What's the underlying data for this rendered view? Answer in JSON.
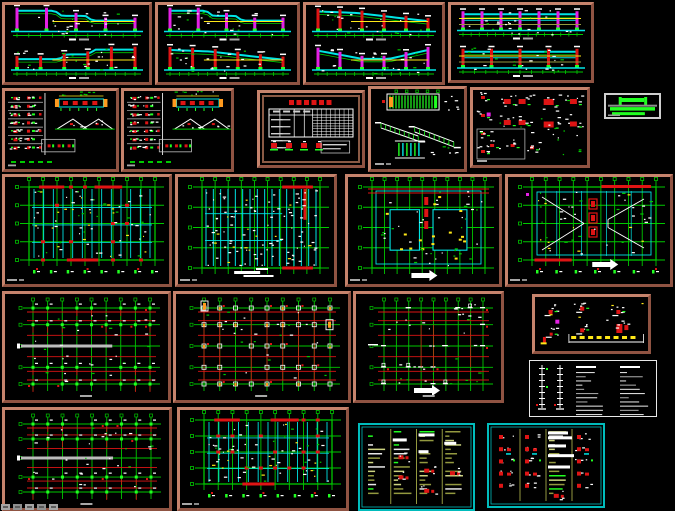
{
  "canvas": {
    "w": 675,
    "h": 511,
    "bg": "#000000"
  },
  "palette": {
    "salmon": "#b3705c",
    "salmonDark": "#8f5342",
    "green": "#00c800",
    "brightGreen": "#21ff21",
    "cyan": "#00e5e5",
    "cyanBorder": "#00bcbc",
    "red": "#de1414",
    "magenta": "#e520e5",
    "yellow": "#ffe818",
    "orange": "#ff9a1e",
    "white": "#ffffff",
    "gray": "#a8a8a8",
    "olive": "#93993f",
    "oliveLight": "#ccd37f",
    "tableBrown": "#8a5a45"
  },
  "watermark": {
    "blocks": 5
  },
  "panels": [
    {
      "name": "sheet-elevation-1",
      "type": "elevation",
      "x": 2,
      "y": 2,
      "w": 150,
      "h": 83,
      "border": "salmon",
      "seed": 11,
      "sections": [
        {
          "colColor": "magenta",
          "cols": 5,
          "profile": "step-down"
        },
        {
          "colColor": "red",
          "cols": 6,
          "profile": "step-up"
        }
      ]
    },
    {
      "name": "sheet-elevation-2",
      "type": "elevation",
      "x": 155,
      "y": 2,
      "w": 145,
      "h": 83,
      "border": "salmon",
      "seed": 12,
      "sections": [
        {
          "colColor": "magenta",
          "cols": 5,
          "profile": "step-down"
        },
        {
          "colColor": "red",
          "cols": 6,
          "profile": "slope-up"
        }
      ]
    },
    {
      "name": "sheet-elevation-3",
      "type": "elevation",
      "x": 303,
      "y": 2,
      "w": 142,
      "h": 83,
      "border": "salmon",
      "seed": 13,
      "sections": [
        {
          "colColor": "red",
          "cols": 6,
          "profile": "slope-up"
        },
        {
          "colColor": "magenta",
          "cols": 6,
          "profile": "valley"
        }
      ]
    },
    {
      "name": "sheet-elevation-4",
      "type": "elevation",
      "x": 448,
      "y": 2,
      "w": 146,
      "h": 81,
      "border": "salmon",
      "seed": 14,
      "sections": [
        {
          "colColor": "magenta",
          "cols": 7,
          "profile": "flat",
          "yellowFull": true
        },
        {
          "colColor": "red",
          "cols": 5,
          "profile": "flat",
          "yellowFull": true
        }
      ]
    },
    {
      "name": "sheet-details-1",
      "type": "details",
      "x": 2,
      "y": 88,
      "w": 117,
      "h": 84,
      "border": "salmon",
      "seed": 21
    },
    {
      "name": "sheet-details-2",
      "type": "details",
      "x": 121,
      "y": 88,
      "w": 113,
      "h": 84,
      "border": "salmon",
      "seed": 22
    },
    {
      "name": "sheet-schedule-table",
      "type": "table",
      "x": 257,
      "y": 90,
      "w": 108,
      "h": 78,
      "border": "salmon",
      "seed": 23
    },
    {
      "name": "sheet-stairs",
      "type": "stairs",
      "x": 368,
      "y": 86,
      "w": 99,
      "h": 86,
      "border": "salmon",
      "seed": 24
    },
    {
      "name": "sheet-details-3",
      "type": "details2",
      "x": 470,
      "y": 87,
      "w": 120,
      "h": 81,
      "border": "salmon",
      "seed": 25
    },
    {
      "name": "legend-block",
      "type": "logo",
      "x": 604,
      "y": 93,
      "w": 57,
      "h": 26,
      "border": "gray",
      "seed": 26
    },
    {
      "name": "sheet-plan-1",
      "type": "plan",
      "variant": "beams-red",
      "x": 2,
      "y": 174,
      "w": 170,
      "h": 113,
      "border": "salmon",
      "seed": 31
    },
    {
      "name": "sheet-plan-2",
      "type": "plan",
      "variant": "beams-dense",
      "x": 175,
      "y": 174,
      "w": 162,
      "h": 113,
      "border": "salmon",
      "seed": 32
    },
    {
      "name": "sheet-plan-3",
      "type": "plan",
      "variant": "voids",
      "x": 345,
      "y": 174,
      "w": 157,
      "h": 113,
      "border": "salmon",
      "seed": 33
    },
    {
      "name": "sheet-plan-4",
      "type": "plan",
      "variant": "roof",
      "x": 505,
      "y": 174,
      "w": 168,
      "h": 113,
      "border": "salmon",
      "seed": 34
    },
    {
      "name": "sheet-column-plan-1",
      "type": "colplan",
      "variant": "graybar",
      "x": 2,
      "y": 291,
      "w": 169,
      "h": 112,
      "border": "salmon",
      "seed": 41
    },
    {
      "name": "sheet-column-plan-2",
      "type": "colplan",
      "variant": "orange",
      "x": 173,
      "y": 291,
      "w": 178,
      "h": 112,
      "border": "salmon",
      "seed": 42
    },
    {
      "name": "sheet-column-plan-3",
      "type": "colplan",
      "variant": "sparse",
      "x": 353,
      "y": 291,
      "w": 151,
      "h": 112,
      "border": "salmon",
      "seed": 43
    },
    {
      "name": "sheet-foundation-details",
      "type": "minidetails",
      "x": 532,
      "y": 294,
      "w": 119,
      "h": 60,
      "border": "salmon",
      "seed": 44
    },
    {
      "name": "sheet-notes-general",
      "type": "notes",
      "x": 529,
      "y": 360,
      "w": 128,
      "h": 57,
      "border": "white",
      "seed": 45
    },
    {
      "name": "sheet-column-plan-4",
      "type": "colplan",
      "variant": "graybar",
      "x": 2,
      "y": 407,
      "w": 170,
      "h": 104,
      "border": "salmon",
      "seed": 51
    },
    {
      "name": "sheet-plan-5",
      "type": "plan",
      "variant": "beams-red",
      "x": 177,
      "y": 407,
      "w": 172,
      "h": 104,
      "border": "salmon",
      "seed": 52
    },
    {
      "name": "sheet-notes-cyan-1",
      "type": "cyannotes",
      "cols": 4,
      "figCols": [],
      "reds": [
        [
          1,
          0.36
        ],
        [
          1,
          0.6
        ],
        [
          2,
          0.52
        ],
        [
          2,
          0.76
        ],
        [
          3,
          0.55
        ]
      ],
      "blobs": [
        [
          1,
          0.16,
          14
        ],
        [
          2,
          0.1,
          16
        ],
        [
          3,
          0.2,
          12
        ],
        [
          2,
          0.3,
          10
        ]
      ],
      "x": 358,
      "y": 423,
      "w": 117,
      "h": 88,
      "border": "cyan",
      "seed": 53
    },
    {
      "name": "sheet-notes-cyan-2",
      "type": "cyannotes",
      "cols": 4,
      "figCols": [
        0,
        1,
        3
      ],
      "reds": [
        [
          2,
          0.85
        ]
      ],
      "blobs": [
        [
          2,
          0.08,
          20
        ],
        [
          2,
          0.14,
          24
        ],
        [
          2,
          0.24,
          18
        ],
        [
          2,
          0.36,
          26
        ],
        [
          2,
          0.5,
          22
        ]
      ],
      "x": 487,
      "y": 423,
      "w": 118,
      "h": 85,
      "border": "cyan",
      "seed": 54
    }
  ]
}
